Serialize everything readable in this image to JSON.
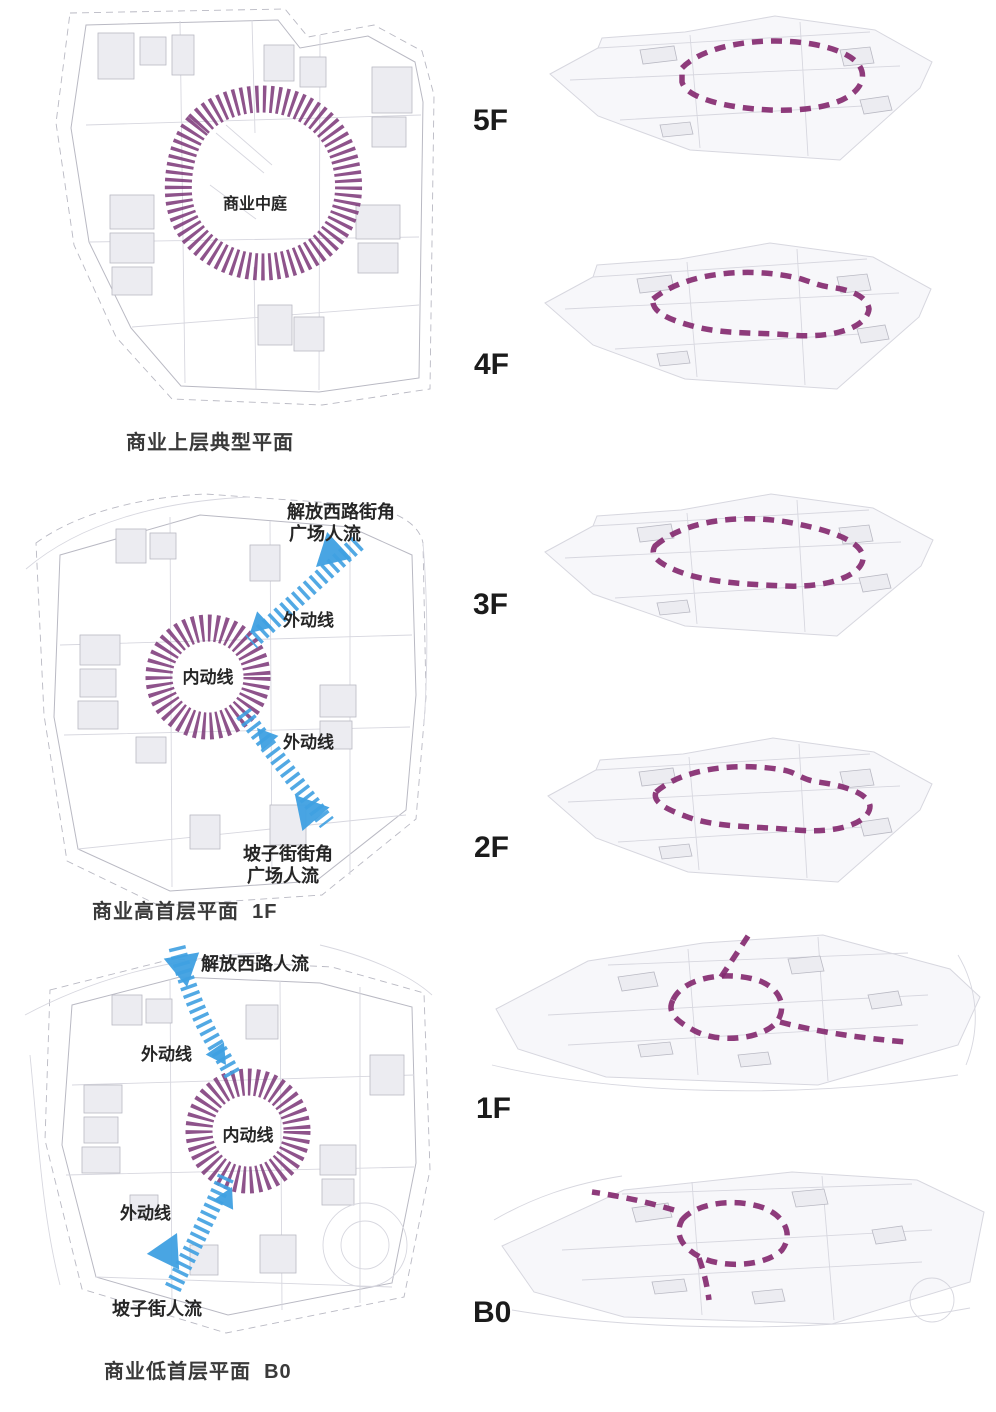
{
  "colors": {
    "purple_ring": "#7a3577",
    "purple_loop": "#842a70",
    "blue": "#3fa0e1",
    "ink": "#1b1b1b",
    "label": "#262626",
    "cad": "#b9b9c3",
    "cad_light": "#d7d7df",
    "cad_fill": "#ececf1",
    "plate_fill": "#f7f7fa"
  },
  "left_column": {
    "upper_plan": {
      "atrium": "商业中庭",
      "caption": "商业上层典型平面"
    },
    "level1_plan": {
      "caption": "商业高首层平面  1F",
      "inflow_top_line1": "解放西路街角",
      "inflow_top_line2": "广场人流",
      "outer_path_top": "外动线",
      "inner_path": "内动线",
      "outer_path_bottom": "外动线",
      "inflow_bottom_line1": "坡子街街角",
      "inflow_bottom_line2": "广场人流"
    },
    "b0_plan": {
      "caption": "商业低首层平面  B0",
      "inflow_top": "解放西路人流",
      "outer_path_top": "外动线",
      "inner_path": "内动线",
      "outer_path_bottom": "外动线",
      "inflow_bottom": "坡子街人流"
    }
  },
  "right_column": {
    "floors": [
      {
        "label": "5F"
      },
      {
        "label": "4F"
      },
      {
        "label": "3F"
      },
      {
        "label": "2F"
      },
      {
        "label": "1F"
      },
      {
        "label": "B0"
      }
    ]
  }
}
